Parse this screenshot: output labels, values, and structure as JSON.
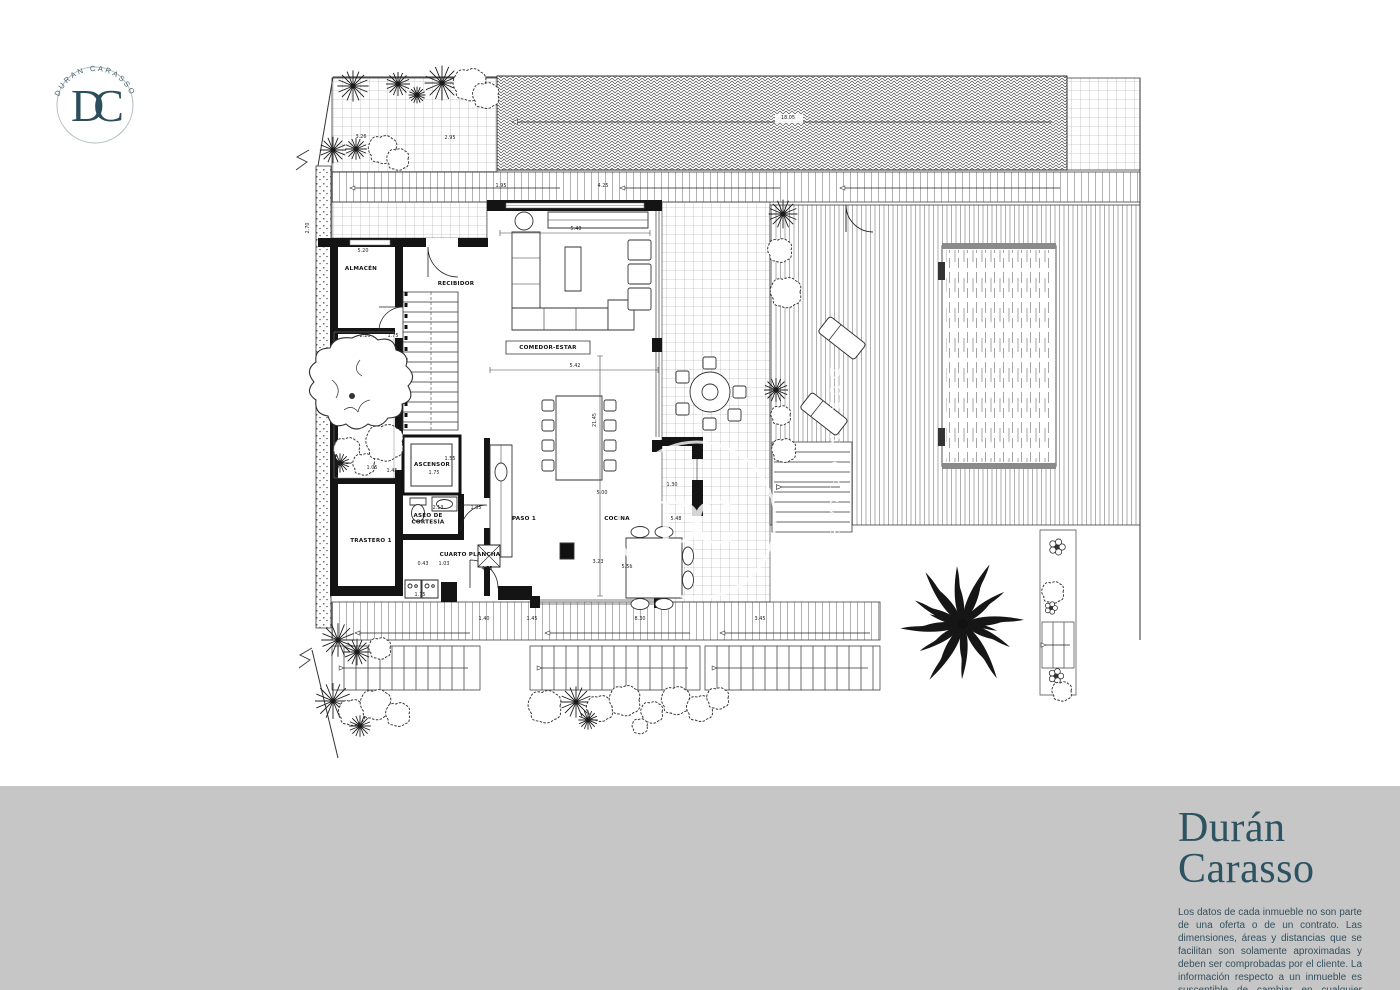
{
  "brand": {
    "monogram": "DC",
    "logo_arc_text": "DURAN CARASSO",
    "name_line1": "Durán",
    "name_line2": "Carasso",
    "accent_color": "#2d5261",
    "footer_bg": "#c6c6c6"
  },
  "footer": {
    "disclaimer": "Los datos de cada inmueble no son parte de una oferta o de un contrato. Las dimensiones, áreas y distancias que se facilitan son solamente aproximadas y deben ser comprobadas por el cliente. La información respecto a un inmueble es susceptible de cambiar en cualquier momento."
  },
  "plan": {
    "watermark": {
      "monogram": "DC",
      "name": "DURAN CARASSO"
    },
    "room_labels": [
      {
        "id": "almacen",
        "label": "ALMACÉN",
        "x": 361,
        "y": 270
      },
      {
        "id": "recibidor",
        "label": "RECIBIDOR",
        "x": 456,
        "y": 285
      },
      {
        "id": "comedor-estar",
        "label": "COMEDOR-ESTAR",
        "x": 548,
        "y": 349,
        "boxed": true
      },
      {
        "id": "cocina",
        "label": "COCINA",
        "x": 617,
        "y": 520
      },
      {
        "id": "paso-1",
        "label": "PASO 1",
        "x": 524,
        "y": 520
      },
      {
        "id": "ascensor",
        "label": "ASCENSOR",
        "x": 432,
        "y": 466
      },
      {
        "id": "aseo-cortesia",
        "label": "ASEO DE",
        "label2": "CORTESÍA",
        "x": 428,
        "y": 517
      },
      {
        "id": "trastero-1",
        "label": "TRASTERO 1",
        "x": 371,
        "y": 542
      },
      {
        "id": "cuarto-plancha",
        "label": "CUARTO PLANCHA",
        "x": 470,
        "y": 556
      }
    ],
    "dimensions": [
      {
        "t": "5.40",
        "x": 576,
        "y": 230
      },
      {
        "t": "5.42",
        "x": 575,
        "y": 367
      },
      {
        "t": "21.45",
        "x": 596,
        "y": 420,
        "rot": -90
      },
      {
        "t": "18.05",
        "x": 788,
        "y": 119
      },
      {
        "t": "2.95",
        "x": 450,
        "y": 139
      },
      {
        "t": "3.26",
        "x": 361,
        "y": 138
      },
      {
        "t": "2.70",
        "x": 309,
        "y": 228,
        "rot": -90
      },
      {
        "t": "5.20",
        "x": 363,
        "y": 252
      },
      {
        "t": "2.20",
        "x": 365,
        "y": 337
      },
      {
        "t": "1.75",
        "x": 393,
        "y": 337
      },
      {
        "t": "1.05",
        "x": 372,
        "y": 469
      },
      {
        "t": "1.45",
        "x": 392,
        "y": 472
      },
      {
        "t": "1.55",
        "x": 450,
        "y": 460
      },
      {
        "t": "1.75",
        "x": 434,
        "y": 474
      },
      {
        "t": "2.13",
        "x": 438,
        "y": 509
      },
      {
        "t": "1.85",
        "x": 476,
        "y": 509
      },
      {
        "t": "0.43",
        "x": 423,
        "y": 565
      },
      {
        "t": "1.03",
        "x": 444,
        "y": 565
      },
      {
        "t": "4.75",
        "x": 487,
        "y": 570
      },
      {
        "t": "1.75",
        "x": 420,
        "y": 596
      },
      {
        "t": "1.40",
        "x": 484,
        "y": 620
      },
      {
        "t": "1.45",
        "x": 532,
        "y": 620
      },
      {
        "t": "8.30",
        "x": 640,
        "y": 620
      },
      {
        "t": "3.45",
        "x": 760,
        "y": 620
      },
      {
        "t": "5.00",
        "x": 602,
        "y": 494
      },
      {
        "t": "1.30",
        "x": 672,
        "y": 486
      },
      {
        "t": "5.48",
        "x": 676,
        "y": 520
      },
      {
        "t": "3.23",
        "x": 598,
        "y": 563
      },
      {
        "t": "5.58",
        "x": 627,
        "y": 568
      },
      {
        "t": "1.95",
        "x": 501,
        "y": 187
      },
      {
        "t": "4.25",
        "x": 603,
        "y": 187
      }
    ]
  }
}
